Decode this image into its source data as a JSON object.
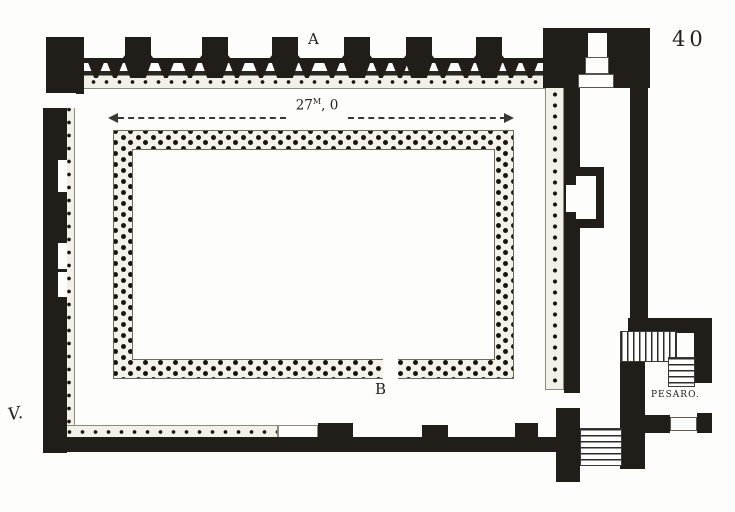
{
  "drawing": {
    "plate_number": "40",
    "labels": {
      "portico": "A",
      "courtyard_entrance": "B",
      "annex": "PESARO."
    },
    "dimension": {
      "whole": "27",
      "unit_superscript": "M",
      "remainder": ", 0"
    },
    "signature": "V."
  },
  "colors": {
    "ink": "#211e1a",
    "paper": "#fdfdfc",
    "band_fill": "#f2f0e8"
  }
}
